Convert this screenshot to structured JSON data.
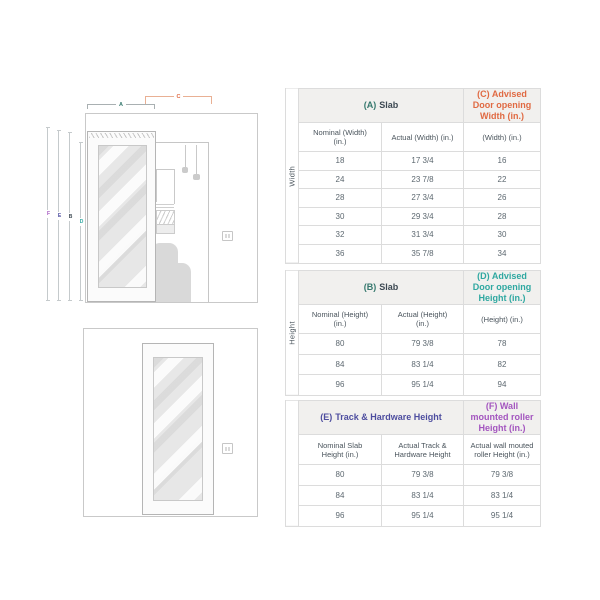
{
  "colors": {
    "teal_dark": "#35786d",
    "teal": "#2fa8a1",
    "orange": "#e06a43",
    "indigo": "#4d4d9f",
    "purple": "#a355bf",
    "dark": "#3c4852",
    "bracket_a_line": "#a9b0b2",
    "bracket_c_line": "#e9b094"
  },
  "diagram": {
    "labels": {
      "a": "A",
      "b": "B",
      "c": "C",
      "d": "D",
      "e": "E",
      "f": "F"
    }
  },
  "tables": [
    {
      "side_label": "Width",
      "col1_header_letter": "(A)",
      "col1_header_text": "Slab",
      "col3_header": "(C) Advised Door opening Width (in.)",
      "subheaders": [
        "Nominal (Width) (in.)",
        "Actual (Width) (in.)",
        "(Width) (in.)"
      ],
      "rows": [
        [
          "18",
          "17 3/4",
          "16"
        ],
        [
          "24",
          "23 7/8",
          "22"
        ],
        [
          "28",
          "27 3/4",
          "26"
        ],
        [
          "30",
          "29 3/4",
          "28"
        ],
        [
          "32",
          "31 3/4",
          "30"
        ],
        [
          "36",
          "35 7/8",
          "34"
        ]
      ]
    },
    {
      "side_label": "Height",
      "col1_header_letter": "(B)",
      "col1_header_text": "Slab",
      "col3_header": "(D) Advised Door opening Height (in.)",
      "subheaders": [
        "Nominal (Height) (in.)",
        "Actual (Height) (in.)",
        "(Height) (in.)"
      ],
      "rows": [
        [
          "80",
          "79 3/8",
          "78"
        ],
        [
          "84",
          "83 1/4",
          "82"
        ],
        [
          "96",
          "95 1/4",
          "94"
        ]
      ]
    },
    {
      "side_label": "",
      "col1_header_letter": "(E)",
      "col1_header_text": "Track & Hardware Height",
      "col3_header": "(F) Wall mounted roller Height (in.)",
      "subheaders": [
        "Nominal Slab Height (in.)",
        "Actual Track & Hardware Height",
        "Actual wall mouted roller Height (in.)"
      ],
      "rows": [
        [
          "80",
          "79 3/8",
          "79 3/8"
        ],
        [
          "84",
          "83 1/4",
          "83 1/4"
        ],
        [
          "96",
          "95 1/4",
          "95 1/4"
        ]
      ]
    }
  ]
}
